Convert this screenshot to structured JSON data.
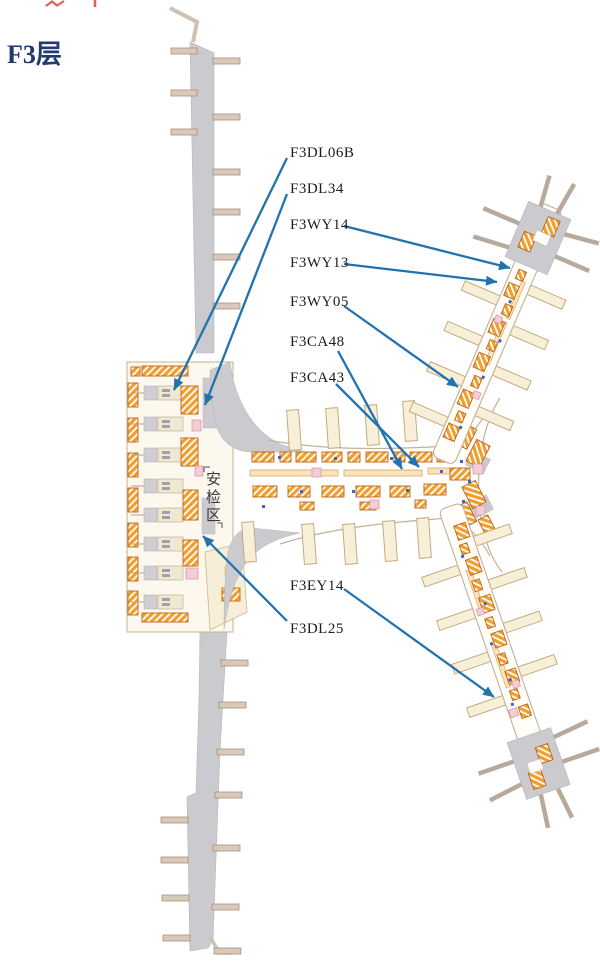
{
  "header": {
    "floor_title": "F3层"
  },
  "security_area": {
    "label": "安检区",
    "chars": [
      "安",
      "检",
      "区"
    ]
  },
  "labels": [
    {
      "text": "F3DL06B"
    },
    {
      "text": "F3DL34"
    },
    {
      "text": "F3WY14"
    },
    {
      "text": "F3WY13"
    },
    {
      "text": "F3WY05"
    },
    {
      "text": "F3CA48"
    },
    {
      "text": "F3CA43"
    },
    {
      "text": "F3EY14"
    },
    {
      "text": "F3DL25"
    }
  ],
  "map": {
    "colors": {
      "shop_orange": "#f09e2e",
      "shop_border": "#bd6314",
      "concourse_gray": "#cbcbcf",
      "gray_border": "#b5b5bb",
      "stub_tan": "#d9c9ba",
      "stub_tan_border": "#a78f7b",
      "stub_beige": "#f8efd8",
      "stub_beige_border": "#bfa472",
      "terminal_fill": "#fdf8ee",
      "terminal_border": "#c5b092",
      "outline_tan": "#c3b197",
      "island_gray": "#cfcfd3",
      "island_beige": "#f0e8d2",
      "accent_pink": "#f3cdd6",
      "accent_pink_border": "#d98fa2",
      "accent_blue_dot": "#3b66c8",
      "light_strip": "#fbe3c0",
      "light_strip_border": "#d49a4e",
      "cap_stub": "#b7aa9c",
      "arrow_blue": "#2173ae",
      "title_navy": "#223a70",
      "red_fragment": "#e0605e"
    }
  }
}
